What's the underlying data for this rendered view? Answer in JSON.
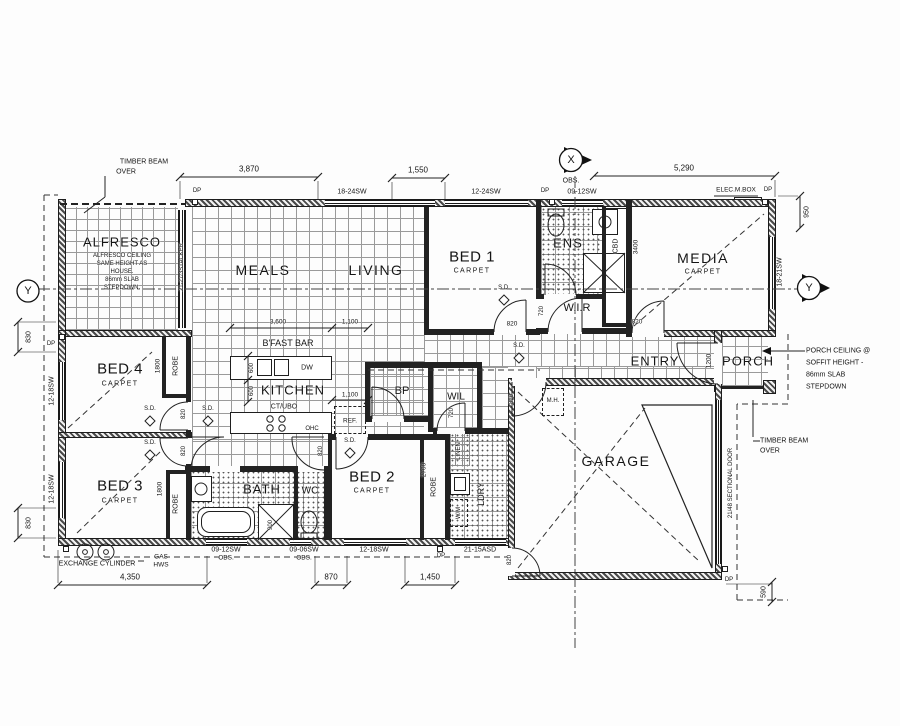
{
  "rooms": {
    "alfresco": "ALFRESCO",
    "alfresco_note": [
      "ALFRESCO CEILING",
      "SAME HEIGHT AS",
      "HOUSE.",
      "86mm SLAB",
      "STEPDOWN."
    ],
    "meals": "MEALS",
    "living": "LIVING",
    "bed1": "BED 1",
    "bed2": "BED 2",
    "bed3": "BED 3",
    "bed4": "BED 4",
    "carpet": "CARPET",
    "ens": "ENS",
    "wir": "W.I.R",
    "media": "MEDIA",
    "cbd": "CBD",
    "entry": "ENTRY",
    "porch": "PORCH",
    "kitchen": "KITCHEN",
    "bfast_bar": "B'FAST BAR",
    "ct_ubo": "CT/UBO",
    "bp": "BP",
    "wil": "WIL",
    "bath": "BATH",
    "wc": "WC",
    "ldry": "LDRY",
    "garage": "GARAGE",
    "robe": "ROBE",
    "linen": "LINEN"
  },
  "fixtures": {
    "dw": "DW",
    "ref": "REF.",
    "ohc": "OHC",
    "wm": "W/M",
    "mh": "M.H.",
    "stacker_door": "21-27/3STACKER",
    "sectional_door": "21/48 SECTIONAL DOOR",
    "exchange_cylinder": "EXCHANGE CYLINDER",
    "gas": "GAS",
    "hws": "HWS",
    "elec_mbox": "ELEC.M.BOX",
    "dp": "DP",
    "sd": "S.D."
  },
  "windows": {
    "w_18_24": "18-24SW",
    "w_12_24": "12-24SW",
    "w_09_12": "09-12SW",
    "w_18_21": "18-21SW",
    "w_12_18": "12-18SW",
    "w_09_06": "09-06SW",
    "d_21_15": "21-15ASD",
    "obs": "OBS."
  },
  "dims": {
    "d3870": "3,870",
    "d1550": "1,550",
    "d5290": "5,290",
    "d950": "950",
    "d830": "830",
    "d590": "590",
    "d4350": "4,350",
    "d870": "870",
    "d1450": "1,450",
    "d3600": "3,600",
    "d1100": "1,100",
    "d3400": "3400",
    "d2700": "2700",
    "d1800": "1800",
    "d1200": "1200",
    "d820": "820",
    "d720": "720",
    "d600": "600",
    "d900": "900"
  },
  "notes": {
    "timber_beam_l1": "TIMBER BEAM",
    "timber_beam_l2": "OVER",
    "porch_note": [
      "PORCH CEILING @",
      "SOFFIT HEIGHT -",
      "86mm SLAB",
      "STEPDOWN"
    ]
  },
  "markers": {
    "x": "X",
    "y": "Y"
  }
}
